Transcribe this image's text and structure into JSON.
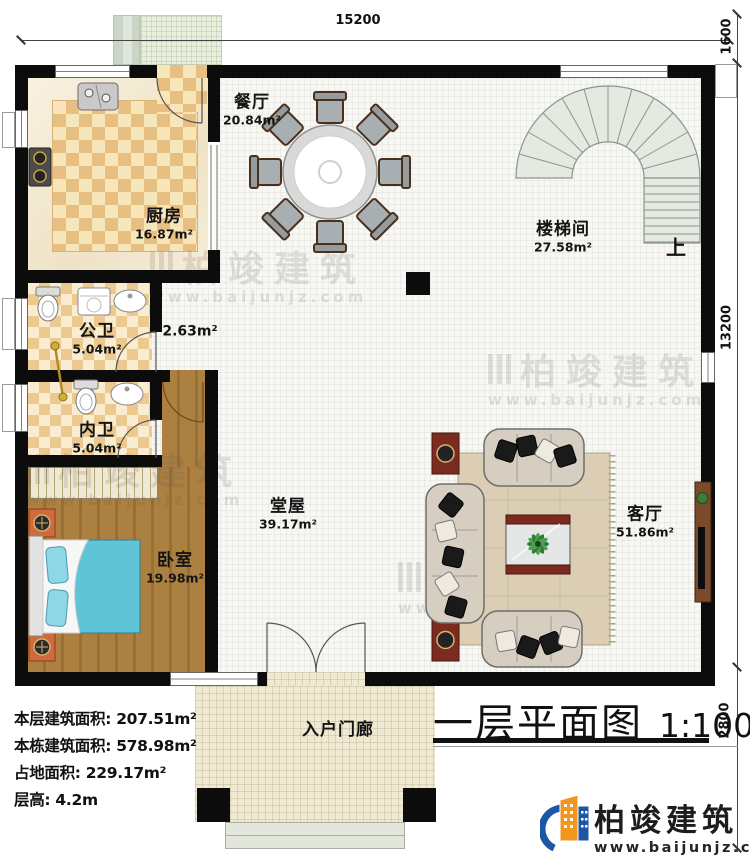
{
  "meta": {
    "title": "一层平面图",
    "scale": "1:100"
  },
  "dimensions": {
    "top": "15200",
    "right_top": "1600",
    "right_side": "13200",
    "right_bottom": "2800"
  },
  "rooms": [
    {
      "name": "厨房",
      "area": "16.87m²"
    },
    {
      "name": "餐厅",
      "area": "20.84m²"
    },
    {
      "name": "楼梯间",
      "area": "27.58m²"
    },
    {
      "name": "公卫",
      "area": "5.04m²"
    },
    {
      "name": "内卫",
      "area": "5.04m²"
    },
    {
      "name": "",
      "area": "2.63m²"
    },
    {
      "name": "卧室",
      "area": "19.98m²"
    },
    {
      "name": "堂屋",
      "area": "39.17m²"
    },
    {
      "name": "客厅",
      "area": "51.86m²"
    },
    {
      "name": "入户门廊",
      "area": ""
    }
  ],
  "stairs": {
    "up_label": "上"
  },
  "info": {
    "lines": [
      "本层建筑面积: 207.51m²",
      "本栋建筑面积: 578.98m²",
      "占地面积: 229.17m²",
      "层高: 4.2m"
    ]
  },
  "brand": {
    "name": "柏竣建筑",
    "website": "www.baijunjz.com"
  },
  "watermark": {
    "name": "柏竣建筑",
    "website": "www.baijunjz.com"
  },
  "colors": {
    "wall": "#0c0c0c",
    "kitchen_checker": "#e7bf82",
    "bath_checker": "#ecca8f",
    "wood_floor": "#ab8041",
    "bed": "#5ec4d6",
    "sofa": "#d5cec1",
    "rug": "#dbceb5",
    "accent_red": "#7c2b1f",
    "stair": "#e4eae2",
    "brand_blue": "#1c57a5",
    "brand_orange": "#f2971d"
  }
}
